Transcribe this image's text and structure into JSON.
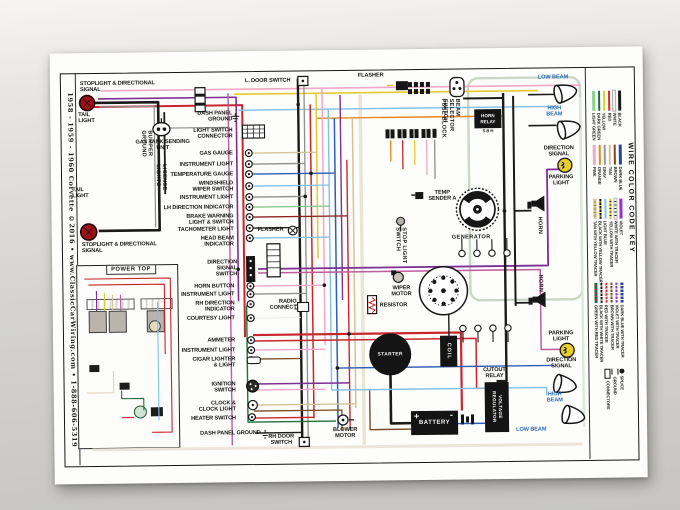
{
  "poster": {
    "side_title": "1958 - 1959 - 1960 Corvette  ©2016 • www.ClassicCarWiring.com • 1-888-606-5319"
  },
  "colors": {
    "label_blue": "#2b6cb3",
    "paper": "#fdfdfb",
    "wire_red": "#c8262c",
    "wire_purple": "#7d2f94"
  },
  "labels": {
    "stoplight_directional_top": "STOPLIGHT & DIRECTIONAL SIGNAL",
    "tail_light_top": "TAIL LIGHT",
    "bumper_ground": "BUMPER GROUND",
    "license_lights": "LICENSE LIGHTS",
    "gas_tank_sending_unit": "GAS TANK SENDING UNIT",
    "tail_light_bottom": "TAIL LIGHT",
    "stoplight_directional_bottom": "STOPLIGHT & DIRECTIONAL SIGNAL",
    "power_top": "POWER TOP",
    "l_door_switch": "L. DOOR SWITCH",
    "flasher_top": "FLASHER",
    "dash_panel_ground_top": "DASH PANEL GROUND",
    "light_switch_connector": "LIGHT SWITCH CONNECTOR",
    "gas_gauge": "GAS GAUGE",
    "instrument_light_1": "INSTRUMENT LIGHT",
    "temperature_gauge": "TEMPERATURE GAUGE",
    "windshield_wiper_switch": "WINDSHIELD WIPER SWITCH",
    "instrument_light_2": "INSTRUMENT LIGHT",
    "lh_direction_indicator": "LH DIRECTION INDICATOR",
    "brake_warning": "BRAKE WARNING LIGHT & SWITCH",
    "tachometer_light": "TACHOMETER LIGHT",
    "flasher_mid": "FLASHER",
    "head_beam_indicator": "HEAD BEAM INDICATOR",
    "direction_signal_switch": "DIRECTION SIGNAL SWITCH",
    "horn_button": "HORN BUTTON",
    "instrument_light_3": "INSTRUMENT LIGHT",
    "rh_direction_indicator": "RH DIRECTION INDICATOR",
    "radio_connect": "RADIO CONNECT",
    "courtesy_light": "COURTESY LIGHT",
    "ammeter": "AMMETER",
    "instrument_light_4": "INSTRUMENT LIGHT",
    "cigar_lighter": "CIGAR LIGHTER & LIGHT",
    "ignition_switch": "IGNITION SWITCH",
    "clock": "CLOCK & CLOCK LIGHT",
    "heater_switch": "HEATER SWITCH",
    "dash_panel_ground_bottom": "DASH PANEL GROUND",
    "rh_door_switch": "RH DOOR SWITCH",
    "blower_motor": "BLOWER MOTOR",
    "battery": "BATTERY",
    "battery_plus": "+",
    "battery_minus": "-",
    "starter": "STARTER",
    "coil": "COIL",
    "cutout_relay": "CUTOUT RELAY",
    "voltage_regulator": "VOLTAGE REGULATOR",
    "resistor": "RESISTOR",
    "wiper_motor": "WIPER MOTOR",
    "stop_light_switch": "STOP LIGHT SWITCH",
    "temp_sender": "TEMP SENDER A",
    "generator": "GENERATOR",
    "fuse_block": "FUSE BLOCK",
    "beam_selector_switch": "BEAM SELECTOR SWITCH",
    "horn_relay": "HORN RELAY",
    "horn_relay_terminals": "S  B  H",
    "horn_1": "HORN",
    "horn_2": "HORN",
    "low_beam_top": "LOW BEAM",
    "high_beam_top": "HIGH BEAM",
    "direction_signal_top": "DIRECTION SIGNAL",
    "parking_light_top": "PARKING LIGHT",
    "parking_light_bottom": "PARKING LIGHT",
    "direction_signal_bottom": "DIRECTION SIGNAL",
    "high_beam_bottom": "HIGH BEAM",
    "low_beam_bottom": "LOW BEAM"
  },
  "key": {
    "title": "WIRE COLOR CODE KEY",
    "groups": [
      [
        {
          "name": "BLACK",
          "css": "background:#1a1a1a"
        },
        {
          "name": "WHITE",
          "css": "background:#f4f4f2;outline:0.4px solid #aaa"
        },
        {
          "name": "RED",
          "css": "background:#d22b2b"
        },
        {
          "name": "YELLOW",
          "css": "background:#e6c92f"
        },
        {
          "name": "DARK GREEN",
          "css": "background:#1e6e3c"
        },
        {
          "name": "LIGHT GREEN",
          "css": "background:#8fd08f"
        }
      ],
      [
        {
          "name": "DARK BLUE",
          "css": "background:#27459c"
        },
        {
          "name": "BROWN",
          "css": "background:#7b4a22"
        },
        {
          "name": "TAN",
          "css": "background:#d6c298"
        },
        {
          "name": "GRAY",
          "css": "background:#979793"
        },
        {
          "name": "ORANGE",
          "css": "background:#e8851f"
        },
        {
          "name": "PINK",
          "css": "background:#f2aac8"
        }
      ],
      [
        {
          "name": "VIOLET",
          "css": "background:#9333c9"
        },
        {
          "name": "WHITE WITH TRACER",
          "css": "background:repeating-linear-gradient(90deg,#f4f4f2 0 2.5px,#222 2.5px 3.5px);outline:0.3px solid #bbb"
        },
        {
          "name": "YELLOW WITH TRACER",
          "css": "background:repeating-linear-gradient(90deg,#e6c92f 0 2.5px,#222 2.5px 3.5px)"
        },
        {
          "name": "LIGHT BLUE",
          "css": "background:#85c6ea"
        },
        {
          "name": "BLACK WITH YELLOW TRACER",
          "css": "background:repeating-linear-gradient(90deg,#1a1a1a 0 2.5px,#e6c92f 2.5px 3.5px)"
        },
        {
          "name": "TAN WITH YELLOW TRACER",
          "css": "background:repeating-linear-gradient(90deg,#d6c298 0 2.5px,#b08d20 2.5px 3.5px)"
        }
      ],
      [
        {
          "name": "DARK BLUE WITH TRACER",
          "css": "background:repeating-linear-gradient(90deg,#27459c 0 2.5px,#fff 2.5px 3.5px)"
        },
        {
          "name": "VIOLET WITH TRACER",
          "css": "background:repeating-linear-gradient(90deg,#9333c9 0 2.5px,#fff 2.5px 3.5px)"
        },
        {
          "name": "BROWN WITH TRACER",
          "css": "background:repeating-linear-gradient(90deg,#7b4a22 0 2.5px,#fff 2.5px 3.5px)"
        },
        {
          "name": "RED WITH TRACER",
          "css": "background:repeating-linear-gradient(90deg,#d22b2b 0 2.5px,#fff 2.5px 3.5px)"
        },
        {
          "name": "BLACK WITH WHITE TRACER",
          "css": "background:repeating-linear-gradient(90deg,#1a1a1a 0 2.5px,#fff 2.5px 3.5px)"
        },
        {
          "name": "GREEN WITH RED TRACER",
          "css": "background:repeating-linear-gradient(90deg,#1e6e3c 0 2.5px,#d22b2b 2.5px 3.5px)"
        }
      ]
    ],
    "symbols": {
      "splice": "SPLICE",
      "ground": "GROUND",
      "connectors": "CONNECTORS"
    }
  }
}
